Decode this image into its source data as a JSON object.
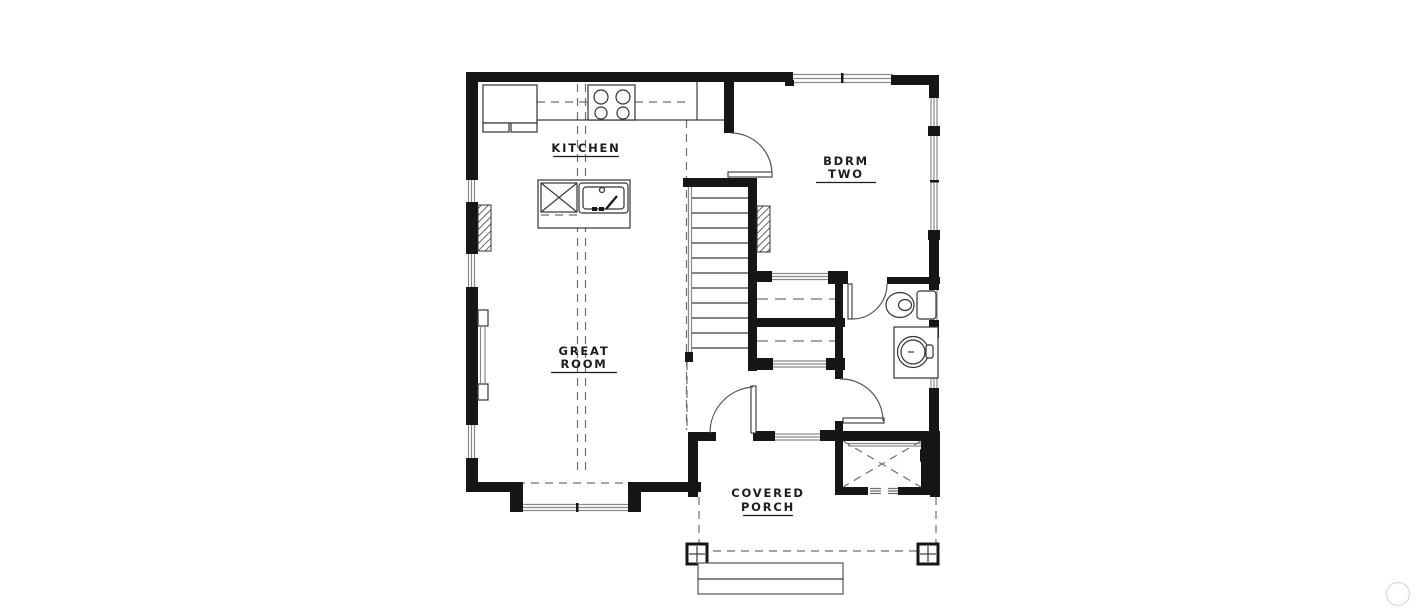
{
  "palette": {
    "background": "#ffffff",
    "wall": "#161616",
    "fixture_line": "#3a3a3a",
    "window_line": "#8a8a8a",
    "dashed_line": "#6f6f6f",
    "label_text": "#1d1d1d",
    "watermark": "#dedede"
  },
  "rooms": {
    "kitchen": {
      "label": "KITCHEN"
    },
    "bedroom_two": {
      "label_line1": "BDRM",
      "label_line2": "TWO"
    },
    "great_room": {
      "label_line1": "GREAT",
      "label_line2": "ROOM"
    },
    "covered_porch": {
      "label_line1": "COVERED",
      "label_line2": "PORCH"
    }
  },
  "fixtures": {
    "kitchen": [
      "refrigerator",
      "range-cooktop",
      "kitchen-island",
      "dishwasher",
      "island-sink",
      "upper-cabinet-dashed-line"
    ],
    "bathroom": [
      "toilet",
      "vanity-sink"
    ],
    "circulation": [
      "stairs",
      "front-entry-door",
      "bedroom-door",
      "bathroom-door",
      "hall-door"
    ],
    "storage": [
      "bedroom-closet-rod",
      "linen-closet-rod",
      "entry-storage-closet-x"
    ],
    "exterior": [
      "covered-porch-slab",
      "porch-columns",
      "entry-steps",
      "bay-window",
      "chimney-hatch",
      "windows"
    ]
  }
}
